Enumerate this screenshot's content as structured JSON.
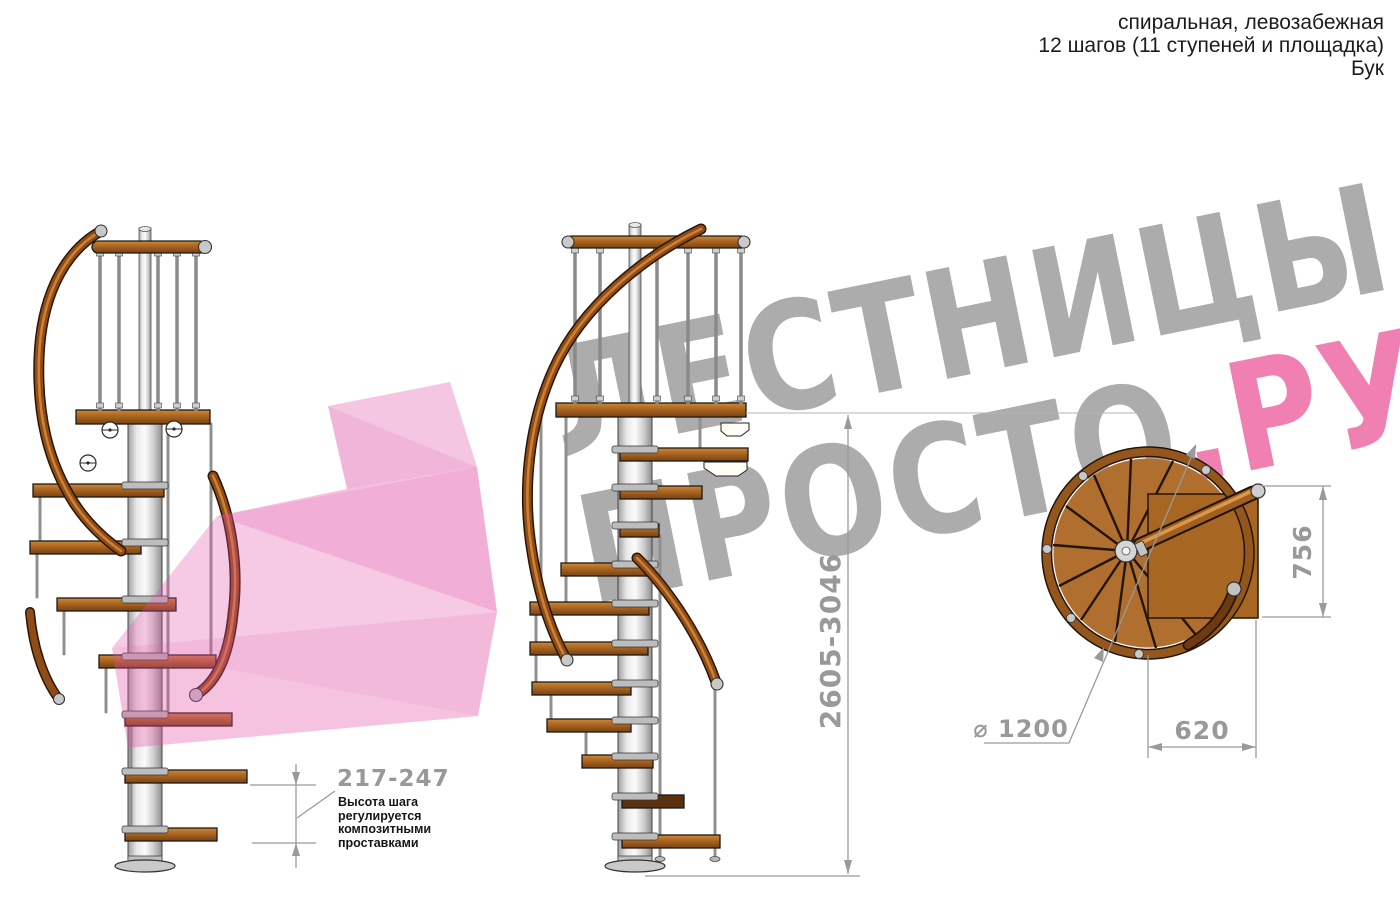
{
  "header": {
    "line1": "спиральная, левозабежная",
    "line2": "12 шагов (11 ступеней и площадка)",
    "line3": "Бук"
  },
  "watermark": {
    "line1": "ЛЕСТНИЦЫ",
    "line2_gray": "ПРОСТО",
    "line2_accent": ".РУ",
    "gray_color": "#acacac",
    "accent_color": "#f07fb2",
    "arrow_color": "#e14fa6"
  },
  "dimensions": {
    "total_height": "2605-3046",
    "landing_depth": "756",
    "landing_width": "620",
    "diameter": "⌀ 1200",
    "step_height": "217-247",
    "step_note_lines": [
      "Высота шага",
      "регулируется",
      "композитными",
      "проставками"
    ],
    "dim_color": "#9a9a9a"
  },
  "materials": {
    "wood": "#b06f2e",
    "wood_dark": "#7a430f",
    "metal": "#d8d8d8",
    "outline": "#1a1a1a"
  }
}
